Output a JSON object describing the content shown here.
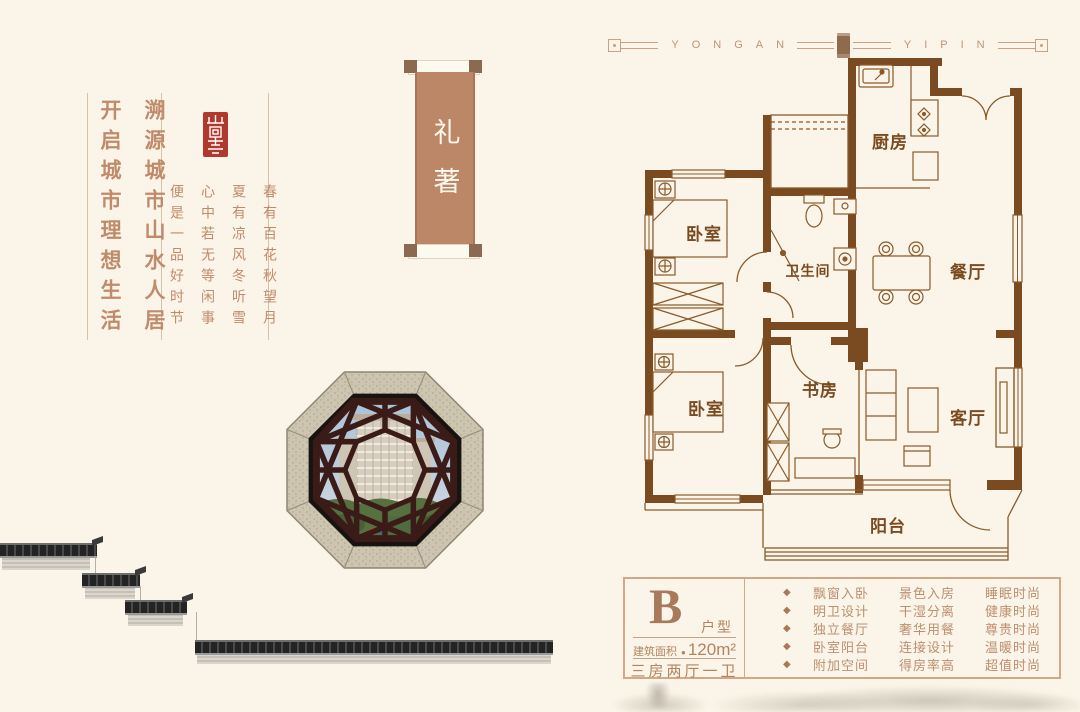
{
  "colors": {
    "background": "#FAF5E8",
    "wall_brown": "#7A4A21",
    "accent_tan": "#C08B6B",
    "seal_red": "#B0392E",
    "scroll_panel": "#BC8767",
    "box_border": "#D2A987"
  },
  "left_panel": {
    "slogans": [
      "溯源城市山水人居",
      "开启城市理想生活"
    ],
    "poem": [
      "春有百花秋望月",
      "夏有凉风冬听雪",
      "心中若无等闲事",
      "便是一品好时节"
    ]
  },
  "scroll_banner": {
    "text": "礼著"
  },
  "plan_header": {
    "left_dot": "·",
    "left_word": "YONGAN",
    "right_word": "YIPIN",
    "right_dot": "·"
  },
  "floor_plan": {
    "rooms": {
      "bedroom1": "卧室",
      "bathroom": "卫生间",
      "kitchen": "厨房",
      "dining": "餐厅",
      "bedroom2": "卧室",
      "study": "书房",
      "living": "客厅",
      "balcony": "阳台"
    }
  },
  "info_box": {
    "type_letter": "B",
    "type_label": "户型",
    "area_label": "建筑面积",
    "area_bullet": "●",
    "area_value": "120m²",
    "layout": "三房两厅一卫",
    "bullet": "◆",
    "features": [
      [
        "飘窗入卧",
        "景色入房",
        "睡眠时尚"
      ],
      [
        "明卫设计",
        "干湿分离",
        "健康时尚"
      ],
      [
        "独立餐厅",
        "奢华用餐",
        "尊贵时尚"
      ],
      [
        "卧室阳台",
        "连接设计",
        "温暖时尚"
      ],
      [
        "附加空间",
        "得房率高",
        "超值时尚"
      ]
    ]
  }
}
